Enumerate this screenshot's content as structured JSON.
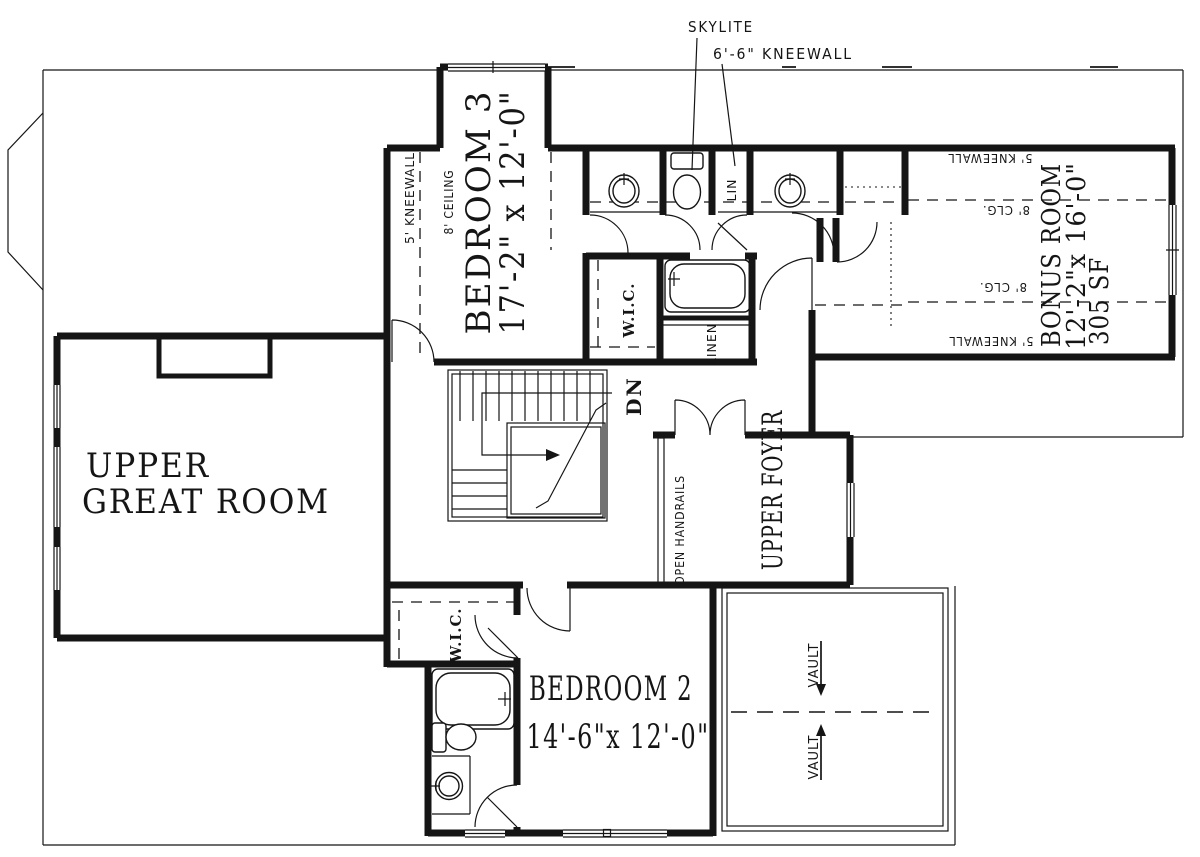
{
  "plan": {
    "annotations": {
      "skylite": "SKYLITE",
      "kneewall66": "6'-6\" KNEEWALL"
    },
    "bedroom3": {
      "name": "BEDROOM 3",
      "dims": "17'-2\" x 12'-0\"",
      "kneewall": "5' KNEEWALL",
      "ceiling": "8' CEILING"
    },
    "bath": {
      "wic": "W.I.C.",
      "linen": "LINEN",
      "lin": "LIN"
    },
    "stairs": {
      "dn": "DN"
    },
    "bonus": {
      "name": "BONUS ROOM",
      "dims": "12'-2\"x 16'-0\"",
      "area": "305 SF",
      "kneewall_top": "5' KNEEWALL",
      "kneewall_bottom": "5' KNEEWALL",
      "clg_top": "8' CLG.",
      "clg_bottom": "8' CLG."
    },
    "great_room": {
      "line1": "UPPER",
      "line2": "GREAT ROOM"
    },
    "foyer": {
      "name": "UPPER FOYER",
      "handrails": "OPEN HANDRAILS"
    },
    "bedroom2": {
      "name": "BEDROOM 2",
      "dims": "14'-6\"x 12'-0\"",
      "wic": "W.I.C."
    },
    "vault": {
      "top": "VAULT",
      "bottom": "VAULT"
    }
  },
  "colors": {
    "ink": "#151515",
    "paper": "#ffffff"
  }
}
